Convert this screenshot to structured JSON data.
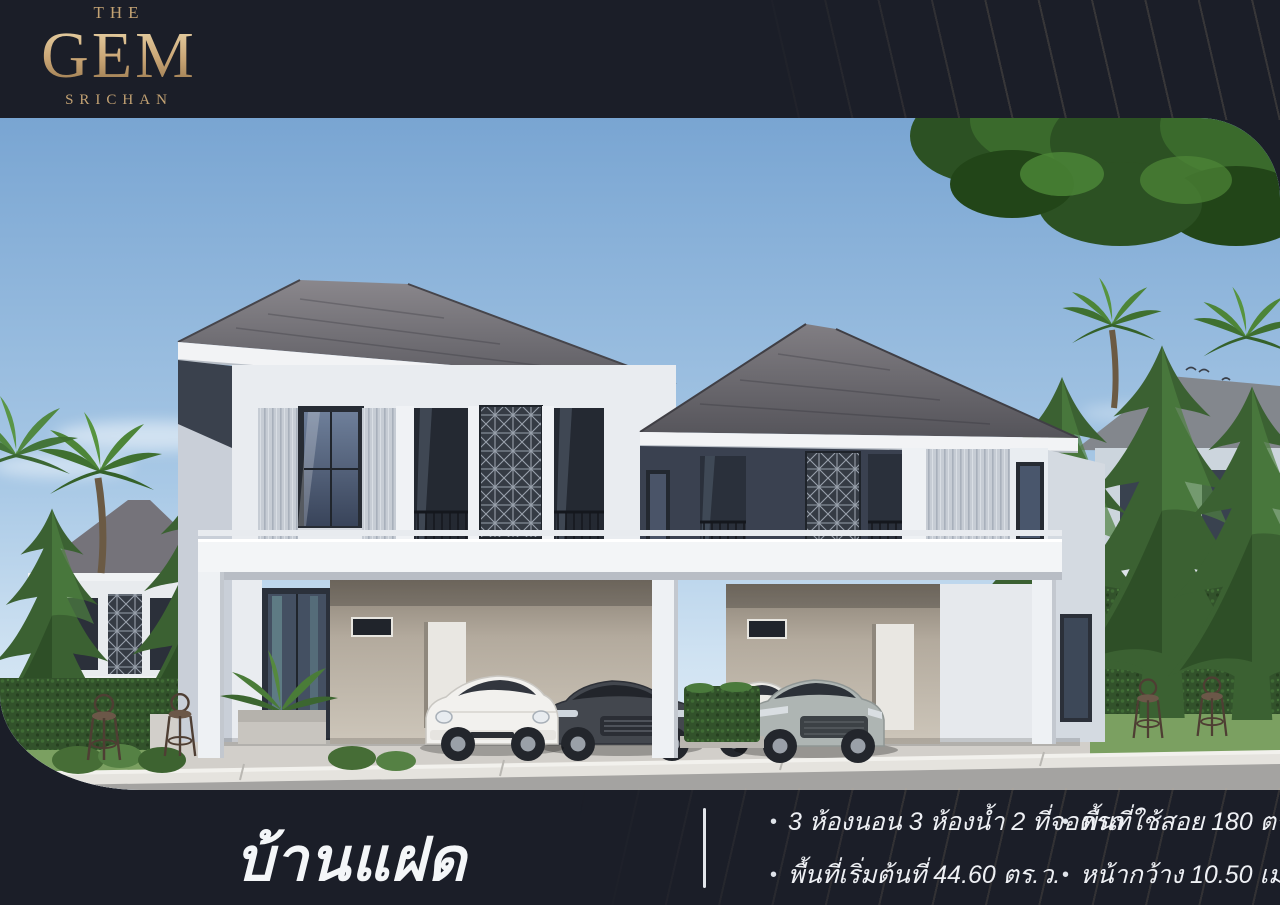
{
  "page": {
    "bg_color": "#1b1e28",
    "gold_color": "#c8a474",
    "text_color": "#f4f6f8"
  },
  "logo": {
    "the": "THE",
    "gem": "GEM",
    "srichan": "SRICHAN"
  },
  "photo": {
    "alt": "3D render of a two-storey twin house with grey hip roofs, white facade, four parked cars, palm trees, conifers and front lawn under a blue sky"
  },
  "title": {
    "text": "บ้านแฝด"
  },
  "specs": {
    "bullet": "•",
    "columns": [
      {
        "items": [
          {
            "text": "3 ห้องนอน 3 ห้องน้ำ 2 ที่จอดรถ"
          },
          {
            "text": "พื้นที่เริ่มต้นที่ 44.60 ตร.ว."
          }
        ]
      },
      {
        "items": [
          {
            "text": "พื้นที่ใช้สอย 180 ตร.ม."
          },
          {
            "text": "หน้ากว้าง 10.50 เมตร"
          }
        ]
      }
    ]
  }
}
